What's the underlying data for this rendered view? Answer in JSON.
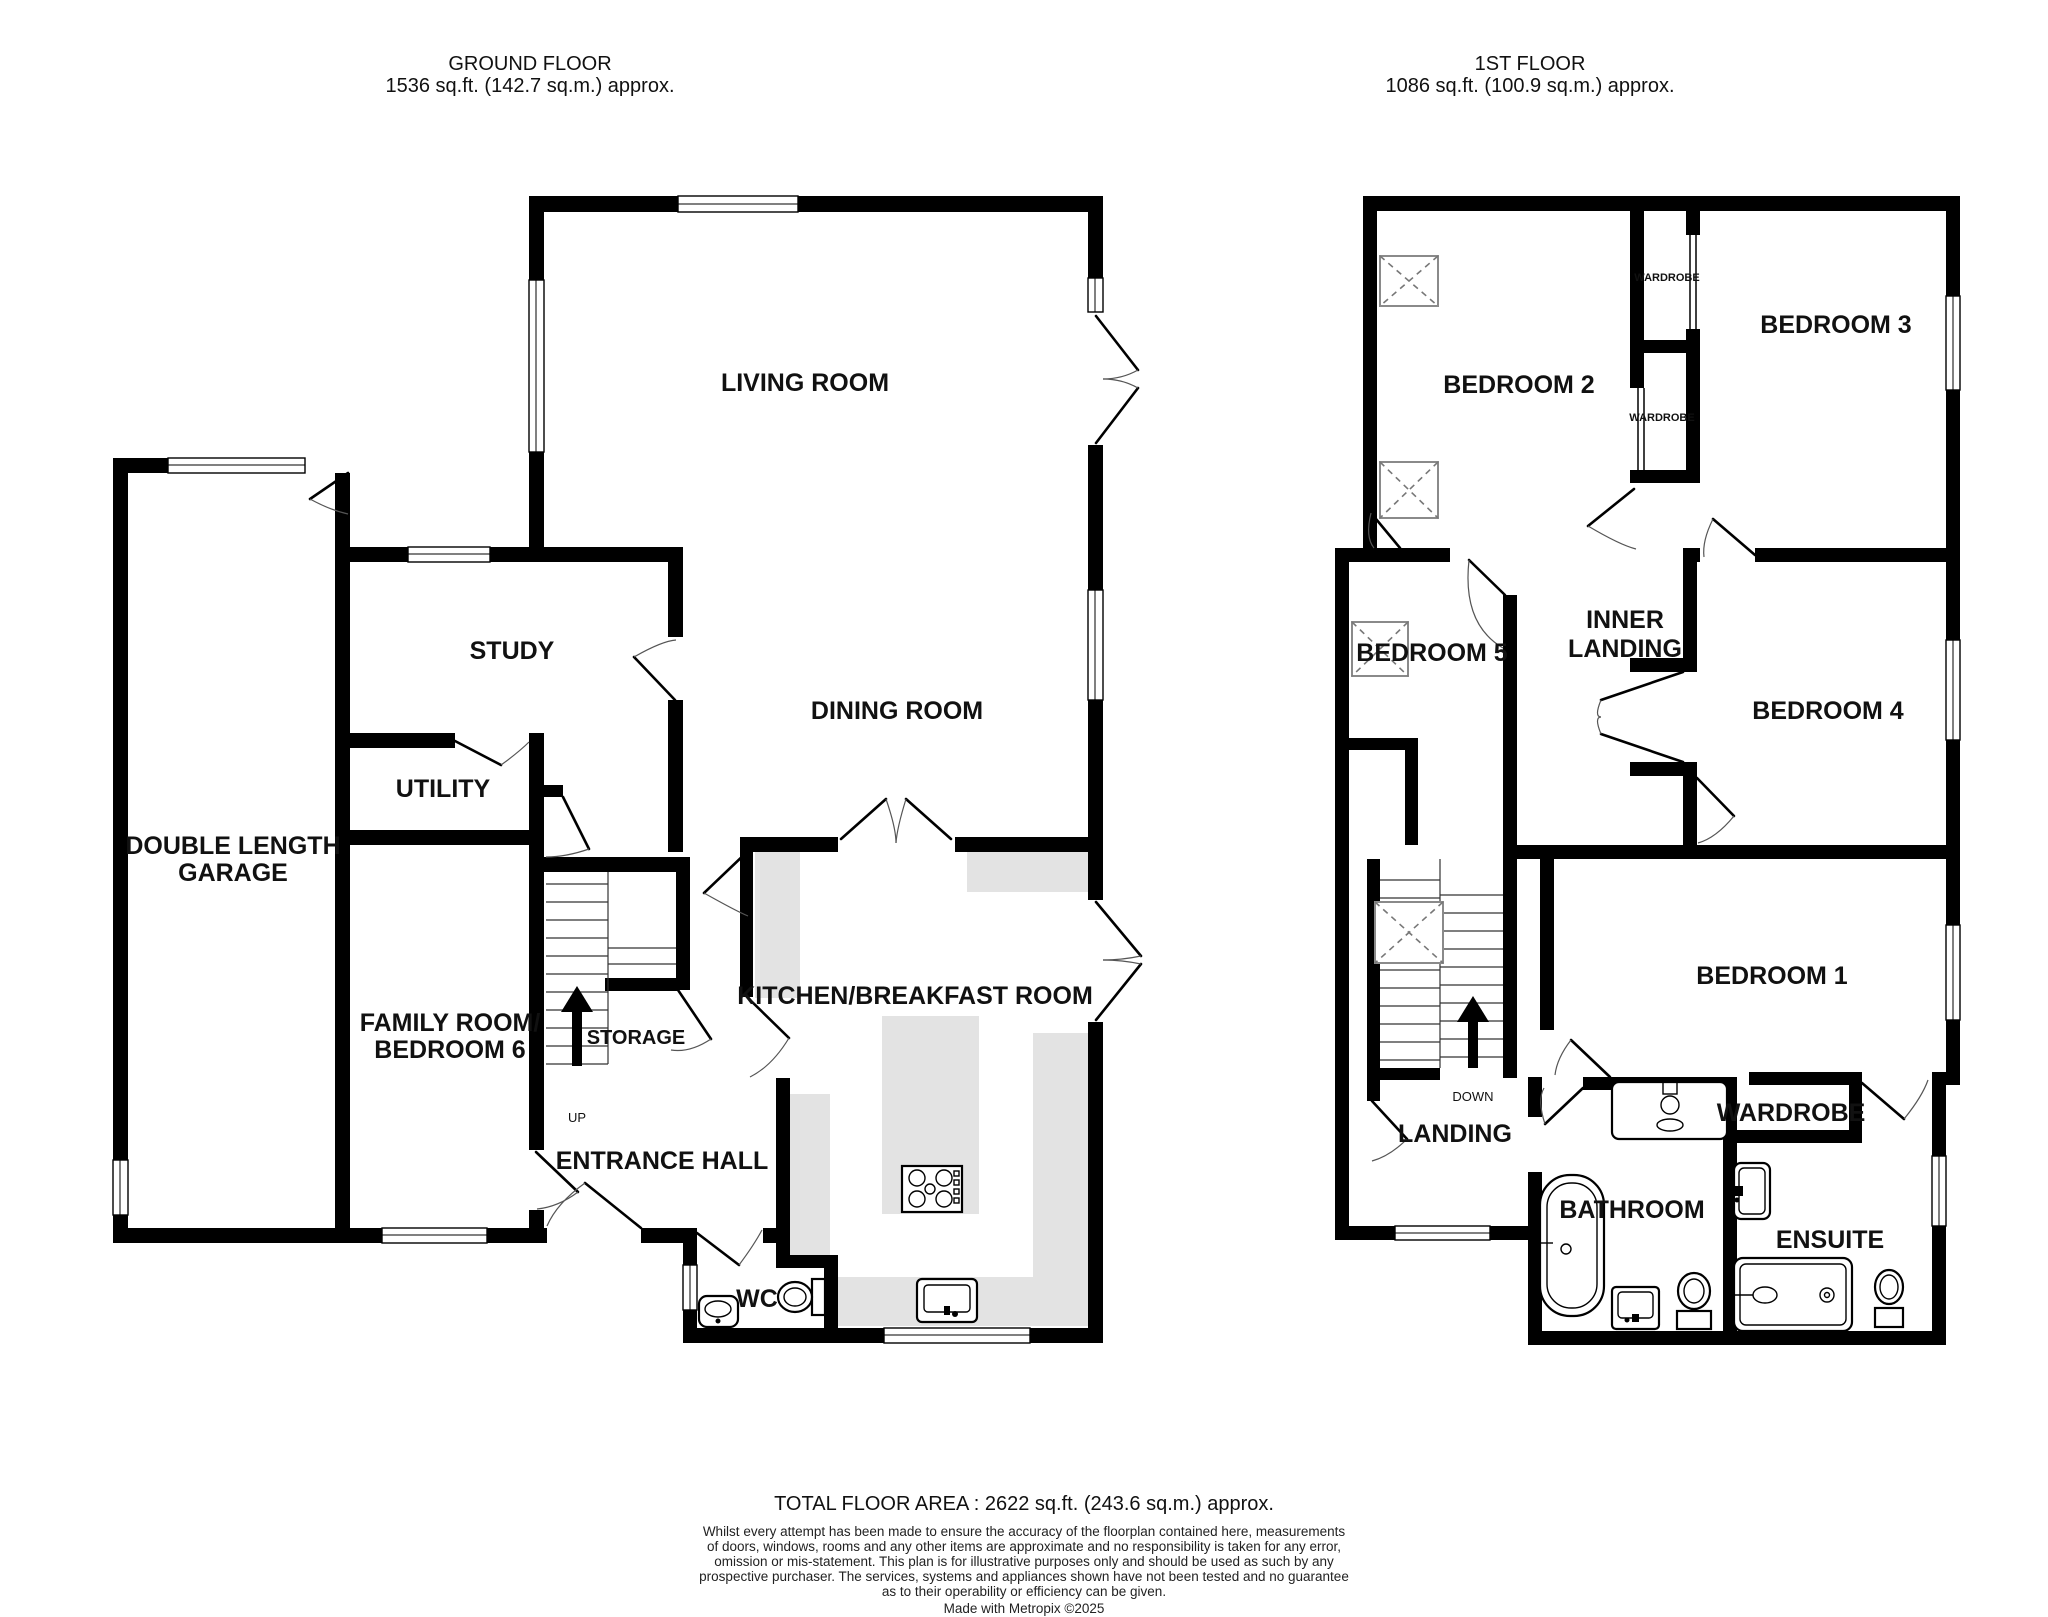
{
  "ground_floor": {
    "header_title": "GROUND FLOOR",
    "header_area": "1536 sq.ft. (142.7 sq.m.) approx.",
    "rooms": {
      "living_room": "LIVING ROOM",
      "study": "STUDY",
      "dining_room": "DINING ROOM",
      "utility": "UTILITY",
      "garage_line1": "DOUBLE LENGTH",
      "garage_line2": "GARAGE",
      "family_line1": "FAMILY ROOM/",
      "family_line2": "BEDROOM 6",
      "storage": "STORAGE",
      "kitchen": "KITCHEN/BREAKFAST ROOM",
      "entrance_hall": "ENTRANCE HALL",
      "wc": "WC",
      "up": "UP"
    }
  },
  "first_floor": {
    "header_title": "1ST FLOOR",
    "header_area": "1086 sq.ft. (100.9 sq.m.) approx.",
    "rooms": {
      "bedroom2": "BEDROOM 2",
      "bedroom3": "BEDROOM 3",
      "wardrobe_small_1": "WARDROBE",
      "wardrobe_small_2": "WARDROBE",
      "bedroom5": "BEDROOM 5",
      "inner_landing_line1": "INNER",
      "inner_landing_line2": "LANDING",
      "bedroom4": "BEDROOM 4",
      "bedroom1": "BEDROOM 1",
      "down": "DOWN",
      "landing": "LANDING",
      "bathroom": "BATHROOM",
      "wardrobe_room": "WARDROBE",
      "ensuite": "ENSUITE"
    }
  },
  "footer": {
    "total": "TOTAL FLOOR AREA : 2622 sq.ft. (243.6 sq.m.) approx.",
    "disclaimer_line1": "Whilst every attempt has been made to ensure the accuracy of the floorplan contained here, measurements",
    "disclaimer_line2": "of doors, windows, rooms and any other items are approximate and no responsibility is taken for any error,",
    "disclaimer_line3": "omission or mis-statement. This plan is for illustrative purposes only and should be used as such by any",
    "disclaimer_line4": "prospective purchaser. The services, systems and appliances shown have not been tested and no guarantee",
    "disclaimer_line5": "as to their operability or efficiency can be given.",
    "credit": "Made with Metropix ©2025"
  }
}
